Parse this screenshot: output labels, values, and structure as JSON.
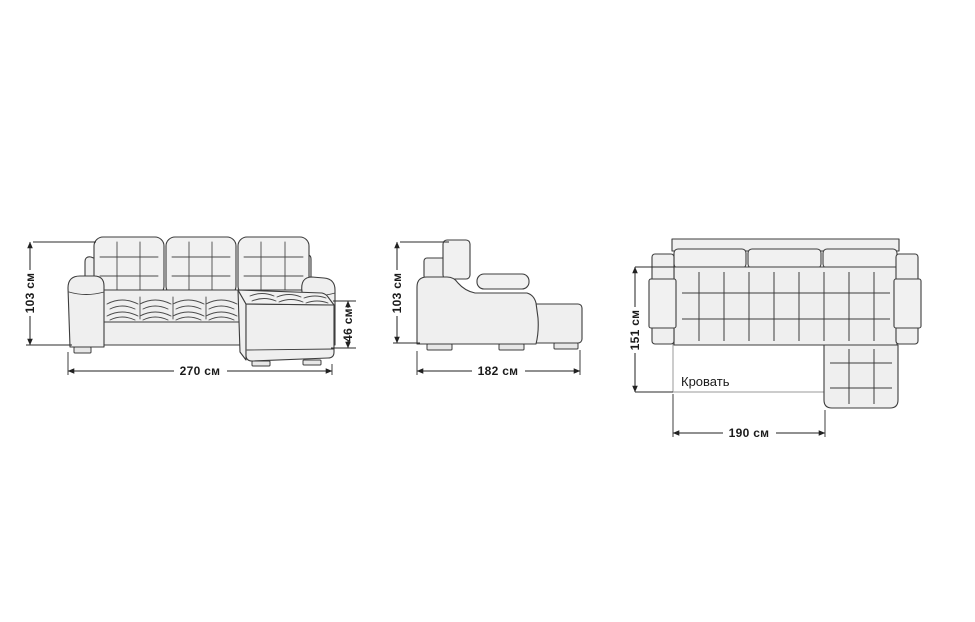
{
  "diagram": {
    "subject": "corner-sofa-dimension-drawing",
    "units": "см",
    "colors": {
      "background": "#ffffff",
      "outline": "#3d3d3d",
      "fill": "#efefef",
      "fill_light": "#f1f1f1",
      "dimension_line": "#222222",
      "bed_outline": "#9a9a9a",
      "label_text": "#1b1b1b"
    },
    "front_view": {
      "height": "103 см",
      "width": "270 см",
      "seat_height": "46 см"
    },
    "side_view": {
      "height": "103 см",
      "depth": "182 см"
    },
    "top_view": {
      "bed_depth": "151 см",
      "bed_width": "190 см",
      "bed_label": "Кровать"
    }
  }
}
